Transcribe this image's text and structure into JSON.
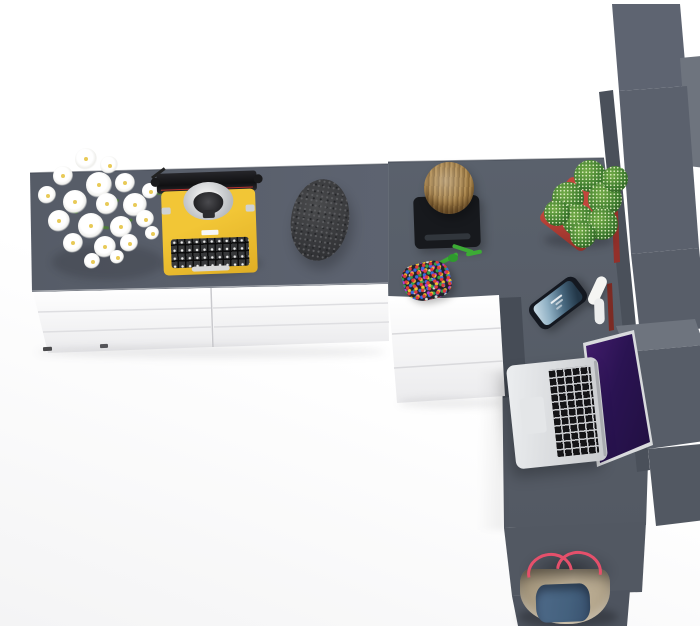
{
  "meta": {
    "title": "Top-down 3D render of an L-shaped desk workstation",
    "description": "Bird's-eye product render: gray-top white sideboard and desk return with tall gray shelf column; decorated with daisies, yellow typewriter, stone pouf, log stool, beaded pouch, cactus, smartphone, open laptop and a tote bag."
  },
  "palette": {
    "desk-gray": "#5a616c",
    "desk-gray-2": "#535963",
    "side-top-1": "#565c67",
    "side-top-2": "#5d6370",
    "white-1": "#ffffff",
    "white-2": "#ebebed",
    "wall-dark": "#464c56",
    "panel-strip": "#4a505a",
    "column-1": "#5e6471",
    "column-2": "#5b616d",
    "column-3": "#585e69",
    "step-top": "#6e747e",
    "step-front": "#575d68",
    "step-low-1": "#525862",
    "step-low-2": "#4e545f",
    "typewriter-yellow": "#f2c636",
    "typewriter-yellow-2": "#dfae25",
    "pot-red": "#c2463c",
    "pot-red-2": "#8f2e27",
    "cactus-green": "#3f7d2f",
    "rope-green": "#3cab35",
    "wood-1": "#b08c52",
    "wood-2": "#6e5227",
    "mat-black": "#17191d",
    "stone-1": "#4a4b4d",
    "stone-2": "#323336",
    "strap-pink": "#e5506b",
    "bag-beige": "#c0b299",
    "bag-blue": "#44617e",
    "laptop-silver": "#d9dbdd",
    "key-black": "#141416",
    "book-red-1": "#93302a",
    "book-red-2": "#7c2b24"
  },
  "objects": {
    "sideboard_top": {
      "label": "Gray sideboard desktop"
    },
    "sideboard_drawers": {
      "label": "White drawer chest under sideboard"
    },
    "return_desk": {
      "label": "Gray desk return surface"
    },
    "return_drawers": {
      "label": "White drawer unit under desk return"
    },
    "shelf_column": {
      "label": "Tall gray shelving column"
    },
    "flowers": {
      "label": "Bouquet of white daisies"
    },
    "typewriter": {
      "label": "Yellow vintage typewriter"
    },
    "stone": {
      "label": "Dark textured stone pouf"
    },
    "stool": {
      "label": "Wooden log stool on black base"
    },
    "pouch": {
      "label": "Multicolor beaded pouch with green cord"
    },
    "cactus": {
      "label": "Cactus in red planter"
    },
    "phone": {
      "label": "Smartphone with blue lock screen"
    },
    "headphones": {
      "label": "White earphones"
    },
    "laptop": {
      "label": "Open silver laptop with purple wallpaper"
    },
    "bag": {
      "label": "Canvas tote bag with pink straps"
    }
  }
}
